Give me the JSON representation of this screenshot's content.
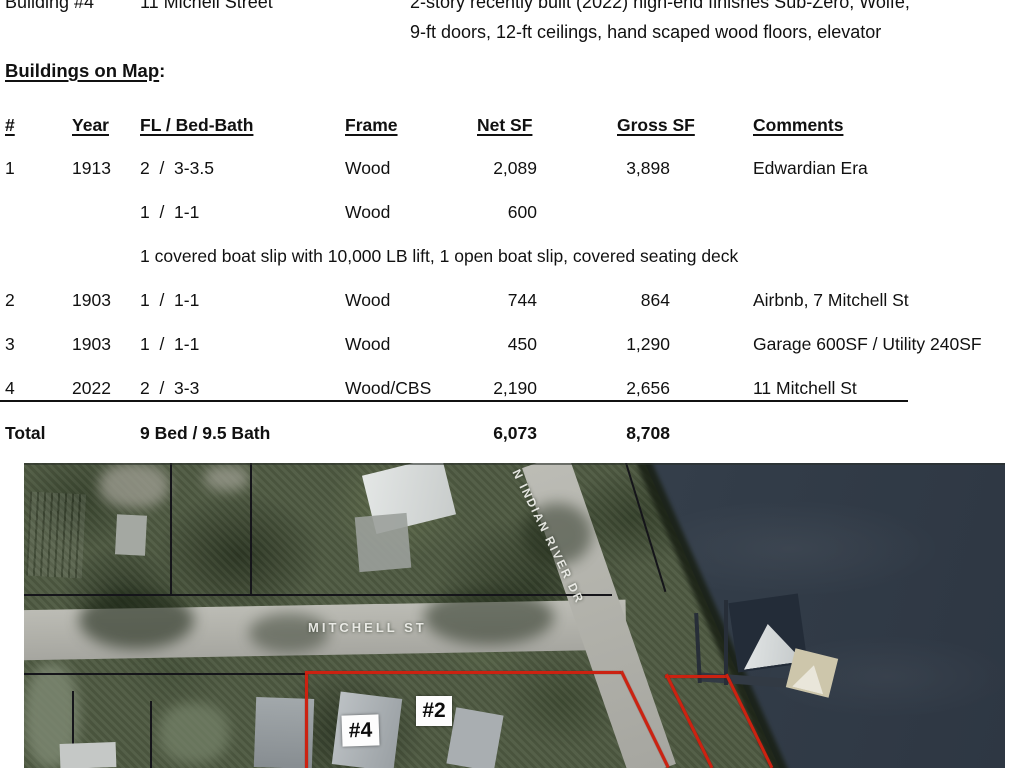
{
  "doc": {
    "building4": {
      "label": "Building #4",
      "address": "11 Michell Street",
      "desc_line1": "2-story recently built (2022) high-end finishes Sub-Zero, Wolfe,",
      "desc_line2": "9-ft doors, 12-ft ceilings, hand scaped wood floors, elevator"
    },
    "section_heading": "Buildings on Map",
    "section_colon": ":",
    "table": {
      "headers": {
        "num": "#",
        "year": "Year",
        "fl_bed": "FL / Bed-Bath",
        "frame": "Frame",
        "net": "Net SF",
        "gross": "Gross SF",
        "comments": "Comments"
      },
      "rows": [
        {
          "num": "1",
          "year": "1913",
          "fl_bed": "2  /  3-3.5",
          "frame": "Wood",
          "net": "2,089",
          "gross": "3,898",
          "comments": "Edwardian Era"
        },
        {
          "num": "",
          "year": "",
          "fl_bed": "1  /  1-1",
          "frame": "Wood",
          "net": "600",
          "gross": "",
          "comments": ""
        },
        {
          "note": "1 covered boat slip with 10,000 LB lift, 1 open boat slip, covered seating deck"
        },
        {
          "num": "2",
          "year": "1903",
          "fl_bed": "1  /  1-1",
          "frame": "Wood",
          "net": "744",
          "gross": "864",
          "comments": "Airbnb, 7 Mitchell St"
        },
        {
          "num": "3",
          "year": "1903",
          "fl_bed": "1  /  1-1",
          "frame": "Wood",
          "net": "450",
          "gross": "1,290",
          "comments": "Garage 600SF / Utility 240SF"
        },
        {
          "num": "4",
          "year": "2022",
          "fl_bed": "2  /  3-3",
          "frame": "Wood/CBS",
          "net": "2,190",
          "gross": "2,656",
          "comments": "11 Mitchell St"
        }
      ],
      "total": {
        "label": "Total",
        "bedbath": "9 Bed / 9.5 Bath",
        "net": "6,073",
        "gross": "8,708"
      }
    }
  },
  "map": {
    "labels": {
      "street_mitchell": "MITCHELL ST",
      "street_indian_river": "N INDIAN RIVER DR",
      "building4_marker": "#4",
      "building2_marker": "#2"
    },
    "colors": {
      "water": "#39434f",
      "trees": "#4f5a42",
      "road": "#b4b4ad",
      "property_outline": "#cc2211",
      "parcel_line": "#15151a"
    }
  }
}
